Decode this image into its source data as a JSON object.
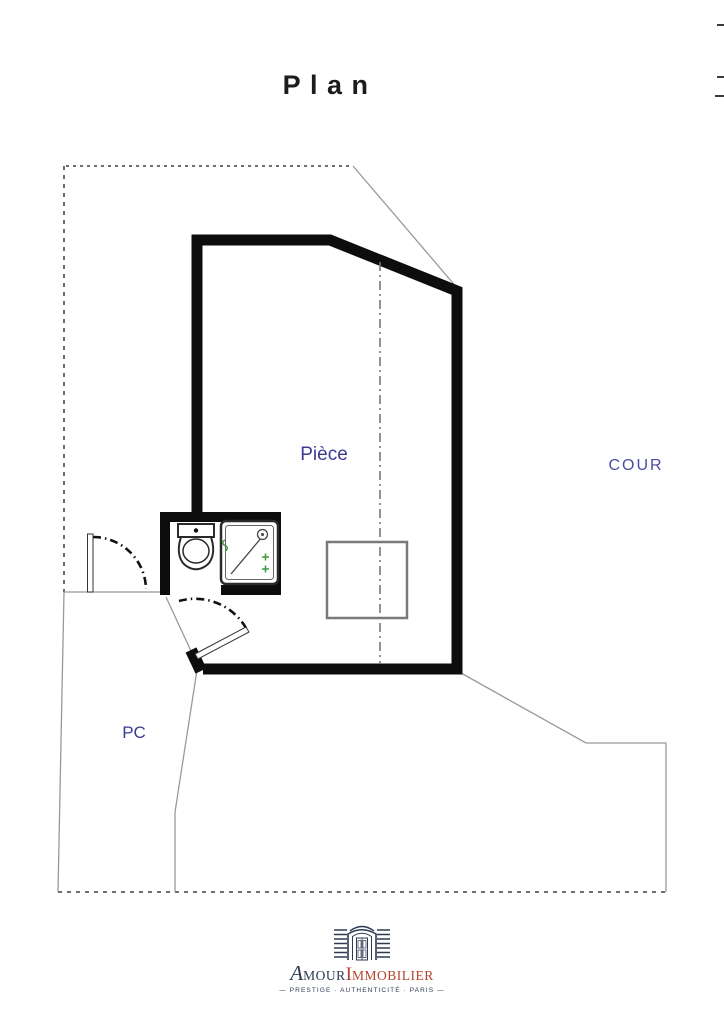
{
  "page": {
    "title": "Plan"
  },
  "plan": {
    "labels": {
      "room": "Pièce",
      "courtyard": "COUR",
      "common_area": "PC"
    },
    "icons": [
      "toilet-icon",
      "shower-icon",
      "door-swing-icon",
      "doorway-logo-icon"
    ]
  },
  "colors": {
    "wall": "#0d0d0d",
    "boundary": "#5a5a5a",
    "thin_line": "#999999",
    "centerline": "#777777",
    "label_blue": "#3b3b94",
    "cour_blue": "#4b4ba0",
    "fixture_green": "#3a9a3a",
    "table_gray": "#7a7a7a",
    "title_color": "#1c1c1c",
    "logo_navy": "#2c3a52",
    "logo_red": "#b5432e"
  },
  "footer_logo": {
    "brand_initial_1": "A",
    "brand_rest_1": "MOUR",
    "brand_initial_2": "I",
    "brand_rest_2": "MMOBILIER",
    "tagline": "—  PRESTIGE · AUTHENTICITÉ · PARIS  —"
  }
}
